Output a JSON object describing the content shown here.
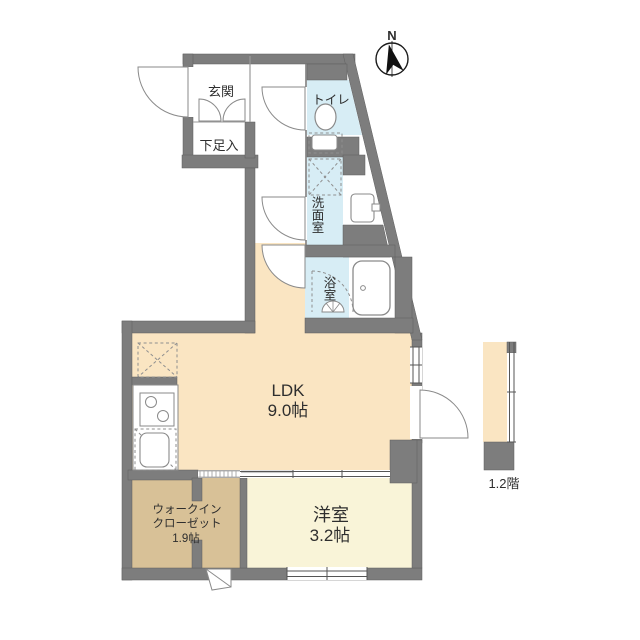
{
  "plan": {
    "title": "1LDK floor plan",
    "compass": {
      "label": "N"
    },
    "rooms": {
      "genkan": {
        "label": "玄関"
      },
      "shoe": {
        "label": "下足入"
      },
      "toilet": {
        "label": "トイレ"
      },
      "washroom": {
        "label": "洗面室"
      },
      "bath": {
        "label": "浴室"
      },
      "ldk": {
        "label": "LDK",
        "size": "9.0帖"
      },
      "western": {
        "label": "洋室",
        "size": "3.2帖"
      },
      "wic": {
        "label_line1": "ウォークイン",
        "label_line2": "クローゼット",
        "size": "1.9帖"
      }
    },
    "annotations": {
      "floor_note": "1.2階"
    },
    "colors": {
      "wall": "#7d7d7d",
      "ldk_floor": "#fae5c2",
      "wet_floor": "#d7edf5",
      "wic_floor": "#d8c197",
      "western_floor": "#f9f4d8",
      "stair_floor": "#fae5c2"
    }
  }
}
